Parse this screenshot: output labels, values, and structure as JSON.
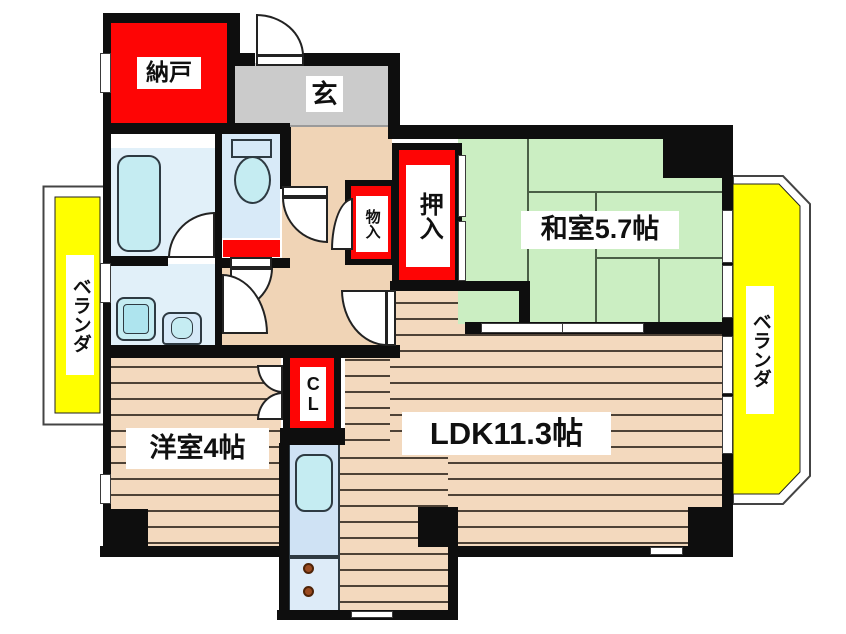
{
  "title": "apartment-floor-plan",
  "labels": {
    "nando": "納戸",
    "genkan": "玄",
    "monoire": "物入",
    "oshiire": "押入",
    "washitsu": "和室5.7帖",
    "ldk": "LDK11.3帖",
    "yoshitsu": "洋室4帖",
    "closet_cl": "CL",
    "veranda": "ベランダ"
  },
  "rooms": [
    {
      "name": "納戸",
      "type": "storage-room"
    },
    {
      "name": "玄",
      "type": "entrance"
    },
    {
      "name": "和室",
      "size_jo": "5.7帖",
      "type": "japanese-room"
    },
    {
      "name": "LDK",
      "size_jo": "11.3帖",
      "type": "living-dining-kitchen"
    },
    {
      "name": "洋室",
      "size_jo": "4帖",
      "type": "western-room"
    },
    {
      "name": "押入",
      "type": "futon-closet"
    },
    {
      "name": "物入",
      "type": "storage-closet"
    },
    {
      "name": "CL",
      "type": "closet"
    },
    {
      "name": "ベランダ",
      "type": "veranda-left"
    },
    {
      "name": "ベランダ",
      "type": "veranda-right"
    }
  ],
  "colors": {
    "wall": "#0e0e0e",
    "closet_red": "#fe0505",
    "tatami_green": "#cbeec2",
    "wood_floor": "#f3d9be",
    "hall_beige": "#f0d4b6",
    "genkan_gray": "#cbcbcb",
    "veranda_yellow": "#ffff00",
    "water_room_blue": "#e1f0f9",
    "fixture_blue": "#c5ecf2",
    "counter_blue": "#cfe2f4",
    "label_bg": "#ffffff",
    "label_text": "#101010"
  },
  "fixtures": [
    "bathtub",
    "toilet",
    "washing-machine",
    "washbasin",
    "kitchen-sink",
    "stove-burners"
  ]
}
